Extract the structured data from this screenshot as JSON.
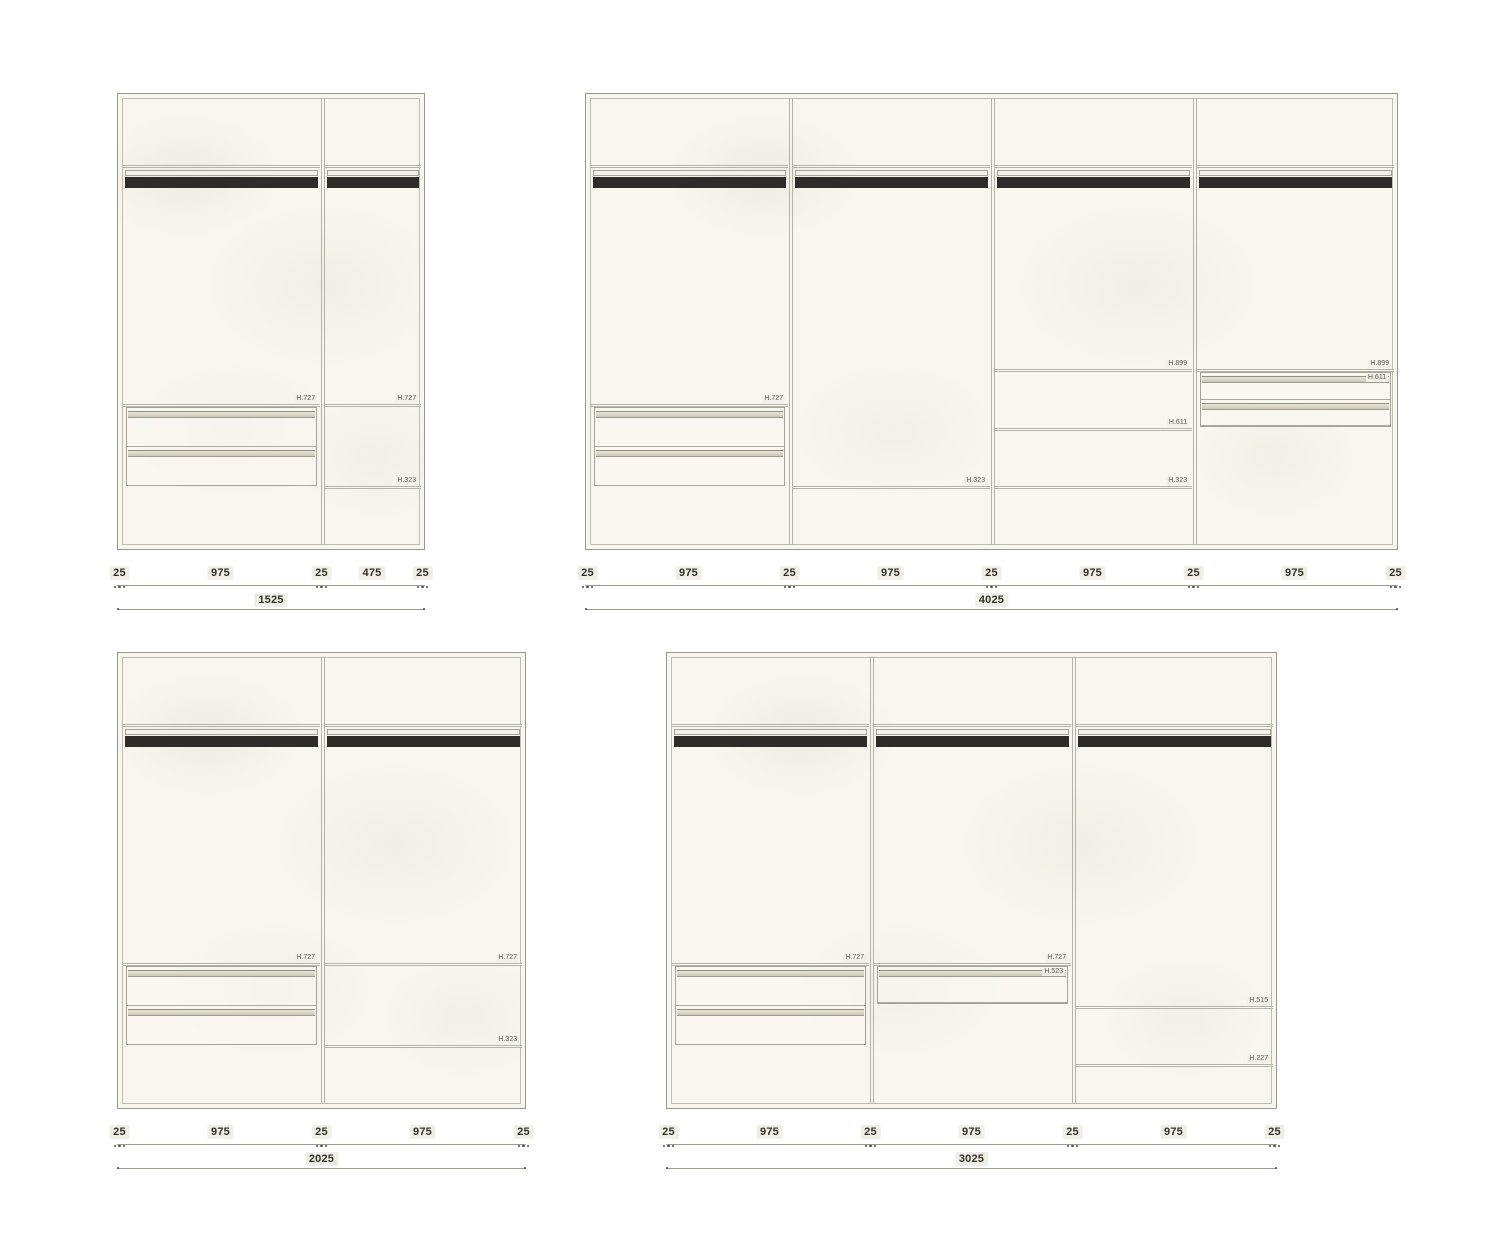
{
  "drawing": {
    "colors": {
      "line": "#97978c",
      "line_light": "#bdbdb1",
      "cabinet_fill": "#f8f6ef",
      "rail_bar": "#2d2c29",
      "drawer_handle": "#cbc8b9",
      "dim_text": "#33332e",
      "dim_badge": "#f0eee6"
    },
    "wardrobes": [
      {
        "id": "w1",
        "total_label": "1525",
        "total_mm": 1525,
        "segment_labels": [
          "25",
          "975",
          "25",
          "475",
          "25"
        ],
        "segments_mm": [
          25,
          975,
          25,
          475,
          25
        ],
        "bays": [
          {
            "width_mm": 975,
            "shelves": [
              {
                "h_mm": 727,
                "label": "H.727"
              }
            ],
            "drawer_units": [
              {
                "top_mm": 727,
                "bottom_mm": 323,
                "drawers": 2,
                "labels": []
              }
            ]
          },
          {
            "width_mm": 475,
            "shelves": [
              {
                "h_mm": 727,
                "label": "H.727"
              },
              {
                "h_mm": 323,
                "label": "H.323"
              }
            ],
            "drawer_units": []
          }
        ]
      },
      {
        "id": "w2",
        "total_label": "4025",
        "total_mm": 4025,
        "segment_labels": [
          "25",
          "975",
          "25",
          "975",
          "25",
          "975",
          "25",
          "975",
          "25"
        ],
        "segments_mm": [
          25,
          975,
          25,
          975,
          25,
          975,
          25,
          975,
          25
        ],
        "bays": [
          {
            "width_mm": 975,
            "shelves": [
              {
                "h_mm": 727,
                "label": "H.727"
              }
            ],
            "drawer_units": [
              {
                "top_mm": 727,
                "bottom_mm": 323,
                "drawers": 2,
                "labels": []
              }
            ]
          },
          {
            "width_mm": 975,
            "shelves": [
              {
                "h_mm": 323,
                "label": "H.323"
              }
            ],
            "drawer_units": []
          },
          {
            "width_mm": 975,
            "shelves": [
              {
                "h_mm": 899,
                "label": "H.899"
              },
              {
                "h_mm": 611,
                "label": "H.611"
              },
              {
                "h_mm": 323,
                "label": "H.323"
              }
            ],
            "drawer_units": []
          },
          {
            "width_mm": 975,
            "shelves": [
              {
                "h_mm": 899,
                "label": "H.899"
              }
            ],
            "drawer_units": [
              {
                "top_mm": 899,
                "bottom_mm": 611,
                "drawers": 2,
                "labels": [
                  "H.611"
                ]
              }
            ]
          }
        ]
      },
      {
        "id": "w3",
        "total_label": "2025",
        "total_mm": 2025,
        "segment_labels": [
          "25",
          "975",
          "25",
          "975",
          "25"
        ],
        "segments_mm": [
          25,
          975,
          25,
          975,
          25
        ],
        "bays": [
          {
            "width_mm": 975,
            "shelves": [
              {
                "h_mm": 727,
                "label": "H.727"
              }
            ],
            "drawer_units": [
              {
                "top_mm": 727,
                "bottom_mm": 323,
                "drawers": 2,
                "labels": []
              }
            ]
          },
          {
            "width_mm": 975,
            "shelves": [
              {
                "h_mm": 727,
                "label": "H.727"
              },
              {
                "h_mm": 323,
                "label": "H.323"
              }
            ],
            "drawer_units": []
          }
        ]
      },
      {
        "id": "w4",
        "total_label": "3025",
        "total_mm": 3025,
        "segment_labels": [
          "25",
          "975",
          "25",
          "975",
          "25",
          "975",
          "25"
        ],
        "segments_mm": [
          25,
          975,
          25,
          975,
          25,
          975,
          25
        ],
        "bays": [
          {
            "width_mm": 975,
            "shelves": [
              {
                "h_mm": 727,
                "label": "H.727"
              }
            ],
            "drawer_units": [
              {
                "top_mm": 727,
                "bottom_mm": 323,
                "drawers": 2,
                "labels": []
              }
            ]
          },
          {
            "width_mm": 975,
            "shelves": [
              {
                "h_mm": 727,
                "label": "H.727"
              }
            ],
            "drawer_units": [
              {
                "top_mm": 727,
                "bottom_mm": 523,
                "drawers": 1,
                "labels": [
                  "H.523"
                ]
              }
            ]
          },
          {
            "width_mm": 975,
            "shelves": [
              {
                "h_mm": 515,
                "label": "H.515"
              },
              {
                "h_mm": 227,
                "label": "H.227"
              }
            ],
            "drawer_units": []
          }
        ]
      }
    ]
  }
}
